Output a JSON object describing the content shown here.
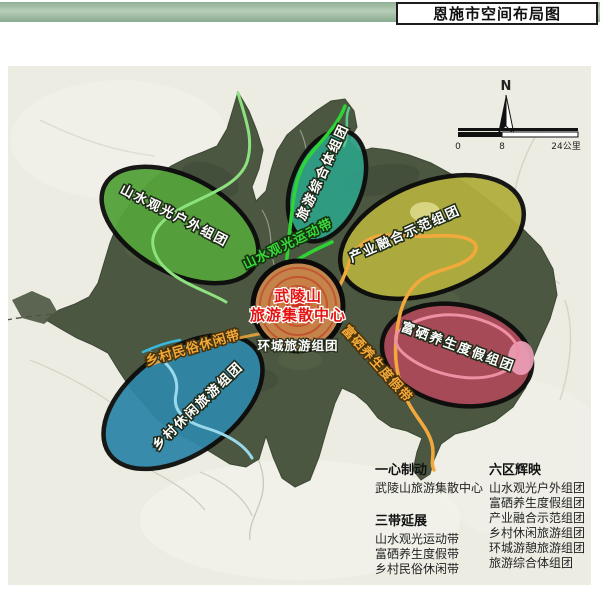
{
  "header": {
    "title": "恩施市空间布局图"
  },
  "map": {
    "compass_label": "N",
    "scale": {
      "t0": "0",
      "t1": "8",
      "t2": "24公里"
    },
    "center_hub": {
      "line1": "武陵山",
      "line2": "旅游集散中心",
      "sub_label": "环城旅游组团",
      "text_color": "#e51212"
    },
    "zones": [
      {
        "label": "山水观光户外组团",
        "color": "#55a23b"
      },
      {
        "label": "旅游综合体组团",
        "color": "#2e9f85"
      },
      {
        "label": "产业融合示范组团",
        "color": "#b2af3e"
      },
      {
        "label": "富硒养生度假组团",
        "color": "#ac4a59"
      },
      {
        "label": "乡村休闲旅游组团",
        "color": "#2f86a7"
      }
    ],
    "belts": [
      {
        "label": "山水观光运动带",
        "color": "#3bd93b"
      },
      {
        "label": "富硒养生度假带",
        "color": "#f3a93a"
      },
      {
        "label": "乡村民俗休闲带",
        "color": "#f3a93a"
      }
    ]
  },
  "legend": {
    "col1": [
      {
        "title": "一心制动",
        "items": [
          "武陵山旅游集散中心"
        ]
      },
      {
        "title": "三带延展",
        "items": [
          "山水观光运动带",
          "富硒养生度假带",
          "乡村民俗休闲带"
        ]
      }
    ],
    "col2": [
      {
        "title": "六区辉映",
        "items": [
          "山水观光户外组团",
          "富硒养生度假组团",
          "产业融合示范组团",
          "乡村休闲旅游组团",
          "环城游憩旅游组团",
          "旅游综合体组团"
        ]
      }
    ]
  }
}
